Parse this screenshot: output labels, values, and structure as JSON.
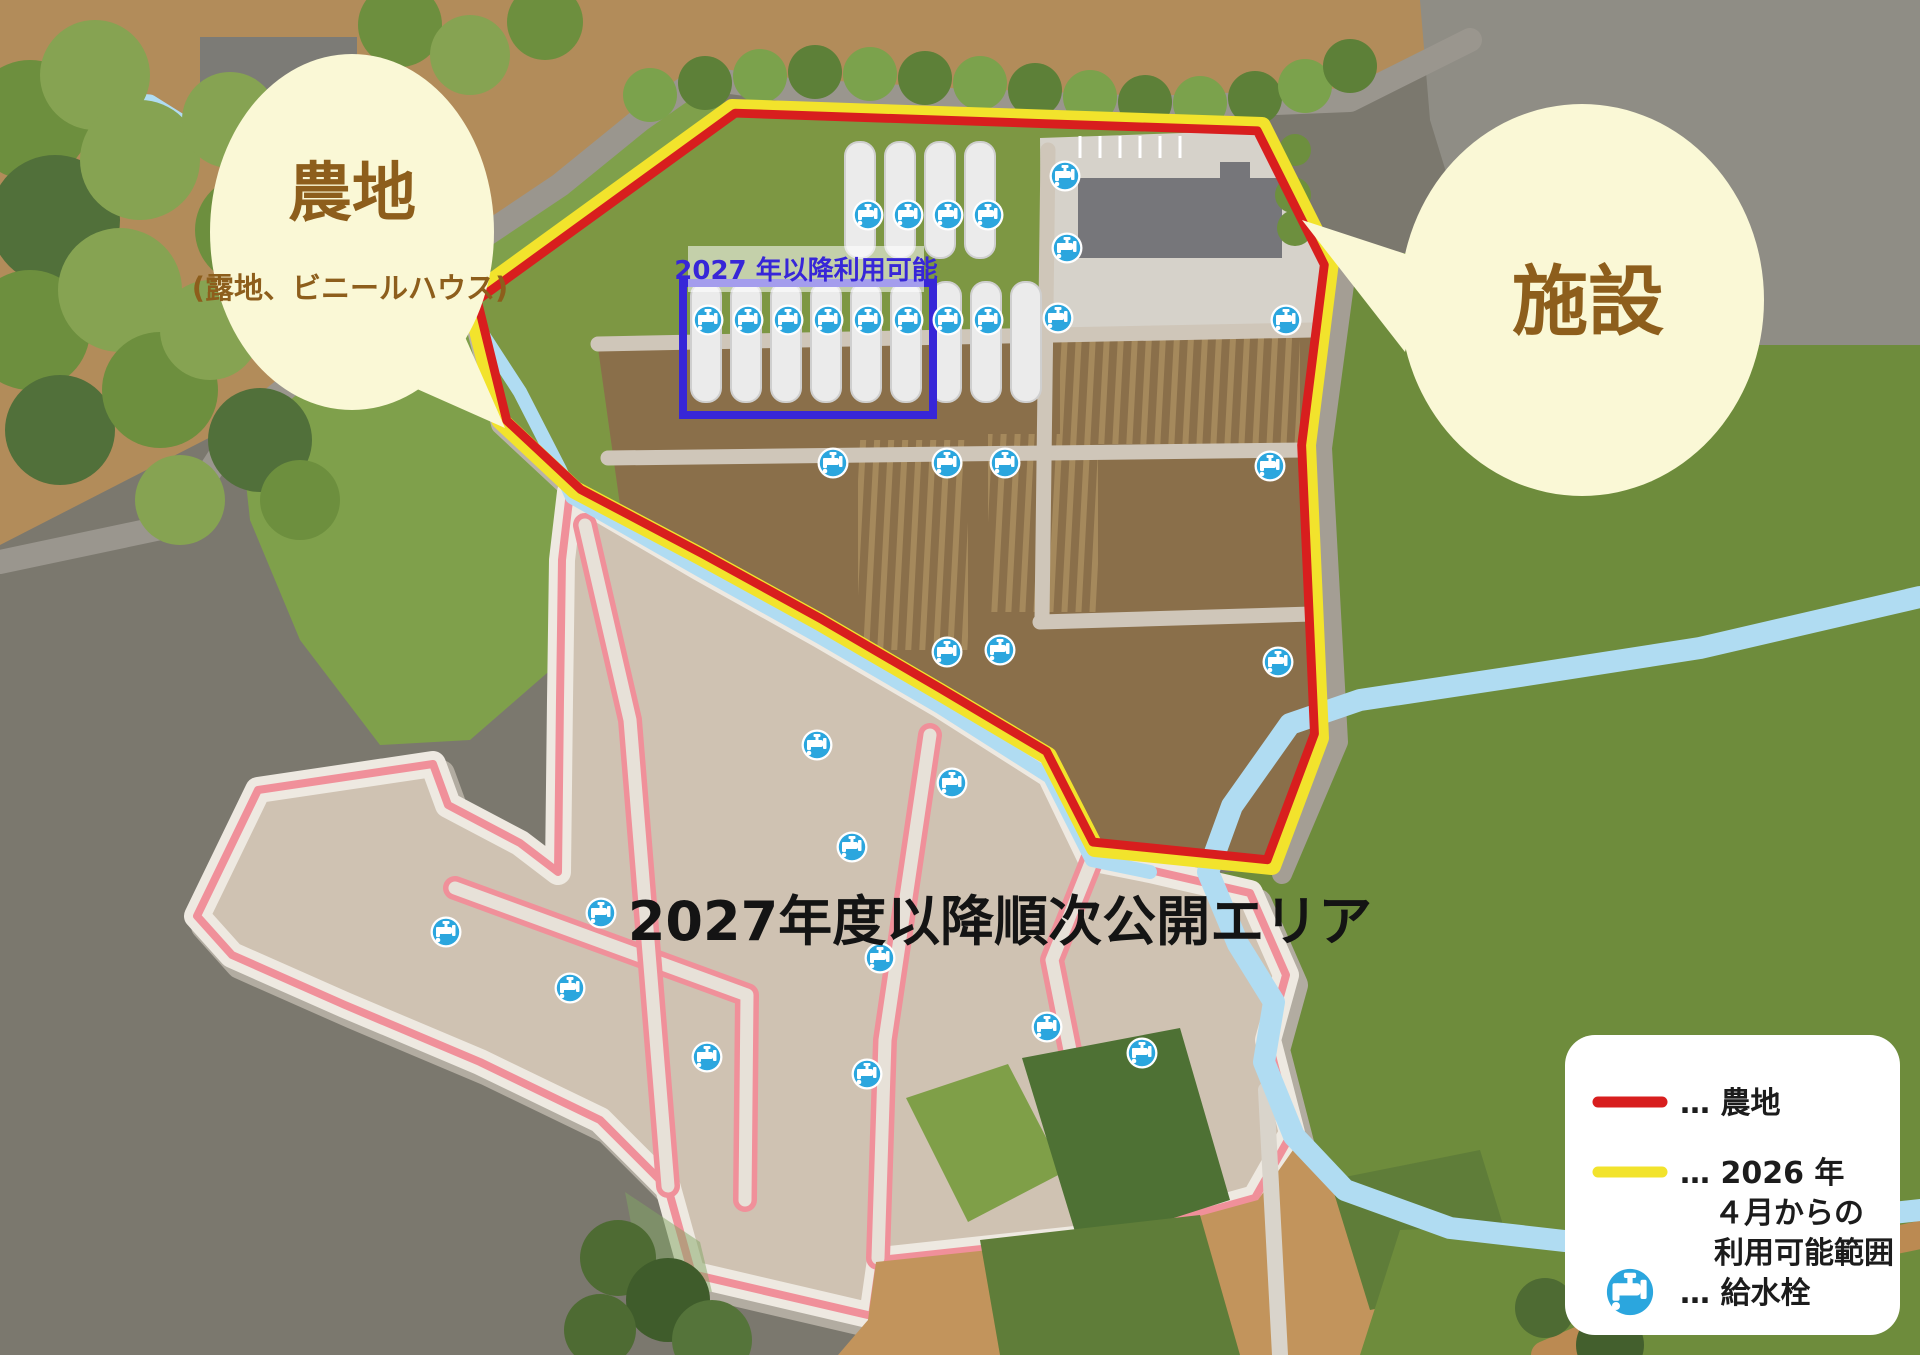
{
  "map": {
    "future_area_label": "2027年度以降順次公開エリア",
    "greenhouse_zone_label": "2027 年以降利用可能"
  },
  "bubbles": {
    "farmland": {
      "title": "農地",
      "subtitle": "(露地、ビニールハウス)"
    },
    "facility": {
      "title": "施設"
    }
  },
  "legend": {
    "items": [
      {
        "type": "line",
        "color": "#d81e1e",
        "label": "… 農地"
      },
      {
        "type": "line",
        "color": "#f2e32c",
        "label": "… 2026 年",
        "line2": "４月からの",
        "line3": "利用可能範囲"
      },
      {
        "type": "icon",
        "icon": "water-tap-icon",
        "label": "… 給水栓"
      }
    ]
  },
  "colors": {
    "farmland_line": "#d81e1e",
    "available_line": "#f2e32c",
    "planned_outline": "#f0909a",
    "water_tap": "#2ba6de",
    "bubble_fill": "#faf8d6",
    "bubble_text": "#8d5e1c",
    "zone_rect": "#3726d8",
    "river": "#b0dcf2"
  },
  "taps": [
    {
      "x": 868,
      "y": 215
    },
    {
      "x": 908,
      "y": 215
    },
    {
      "x": 948,
      "y": 215
    },
    {
      "x": 988,
      "y": 215
    },
    {
      "x": 1065,
      "y": 176
    },
    {
      "x": 1067,
      "y": 248
    },
    {
      "x": 708,
      "y": 320
    },
    {
      "x": 748,
      "y": 320
    },
    {
      "x": 788,
      "y": 320
    },
    {
      "x": 828,
      "y": 320
    },
    {
      "x": 868,
      "y": 320
    },
    {
      "x": 908,
      "y": 320
    },
    {
      "x": 948,
      "y": 320
    },
    {
      "x": 988,
      "y": 320
    },
    {
      "x": 1058,
      "y": 318
    },
    {
      "x": 1286,
      "y": 320
    },
    {
      "x": 833,
      "y": 463
    },
    {
      "x": 947,
      "y": 463
    },
    {
      "x": 1005,
      "y": 463
    },
    {
      "x": 1270,
      "y": 466
    },
    {
      "x": 947,
      "y": 652
    },
    {
      "x": 1000,
      "y": 650
    },
    {
      "x": 1278,
      "y": 662
    },
    {
      "x": 817,
      "y": 745
    },
    {
      "x": 952,
      "y": 783
    },
    {
      "x": 852,
      "y": 847
    },
    {
      "x": 880,
      "y": 958
    },
    {
      "x": 601,
      "y": 913
    },
    {
      "x": 446,
      "y": 932
    },
    {
      "x": 570,
      "y": 988
    },
    {
      "x": 707,
      "y": 1057
    },
    {
      "x": 867,
      "y": 1074
    },
    {
      "x": 1047,
      "y": 1027
    },
    {
      "x": 1142,
      "y": 1053
    }
  ]
}
